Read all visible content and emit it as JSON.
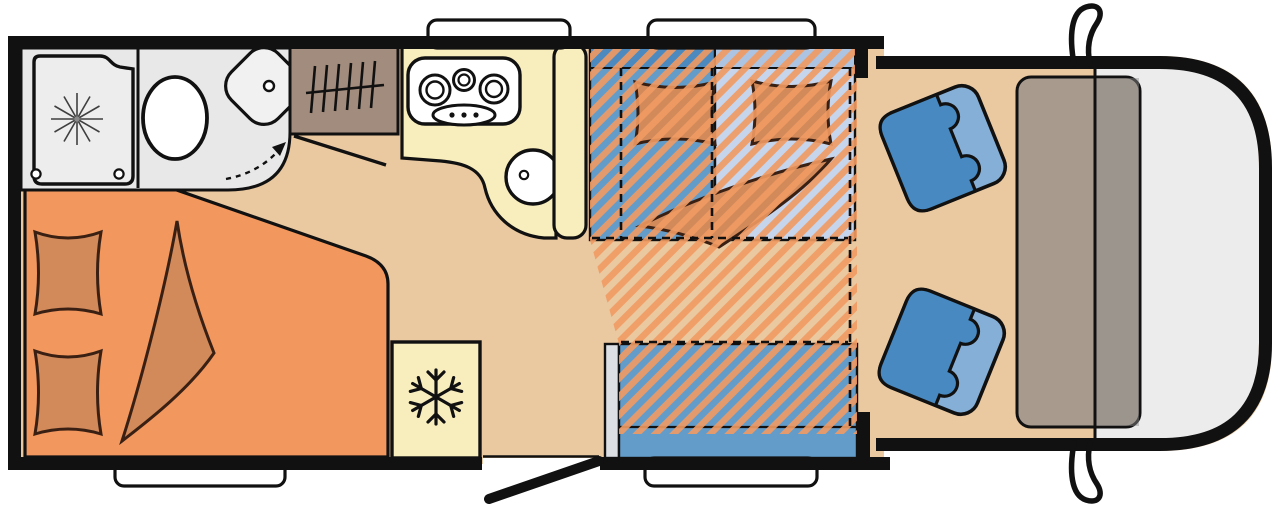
{
  "meta": {
    "type": "motorhome-floorplan",
    "description": "Top-down floor plan of a semi-integrated motorhome with rear bed, bathroom, kitchen, dinette with drop-down bed and driver cab"
  },
  "palette": {
    "outline": "#111111",
    "floor": "#EAC8A0",
    "bed": "#F2975E",
    "pillow": "#D28A5B",
    "pillow_stroke": "#3A2013",
    "bath_bg": "#E8E8E8",
    "tray": "#EDEDED",
    "white": "#FFFFFF",
    "wardrobe": "#A28C7D",
    "cream": "#F8EDBD",
    "bench": "#639CC9",
    "bench_dark": "#4B89BF",
    "mattress": "#C7D5EC",
    "mattress_dark": "#ACC4E1",
    "hatch": "#F19A62",
    "seat_dark": "#4789C0",
    "seat_light": "#85AFD7",
    "panel": "#DCE0E5",
    "dash_taupe": "#A89B8E",
    "dash_grey": "#8F8F8F",
    "nose": "#ECECEC",
    "star": "#3F3F3F"
  },
  "zones": {
    "bathroom": {
      "label": "Bathroom with shower, toilet and corner washbasin"
    },
    "shower": {
      "label": "Shower tray"
    },
    "toilet": {
      "label": "Toilet"
    },
    "washbasin": {
      "label": "Corner washbasin"
    },
    "wardrobe": {
      "label": "Wardrobe with clothes rail"
    },
    "rear_bed": {
      "label": "Rear bed with two pillows and blanket"
    },
    "kitchen": {
      "label": "Kitchen with 3-burner hob and sink"
    },
    "fridge": {
      "label": "Fridge"
    },
    "dinette": {
      "label": "Dinette bench seating"
    },
    "drop_down_bed": {
      "label": "Drop-down bed over dinette (hatched area)"
    },
    "side_bench": {
      "label": "Side bench"
    },
    "cab": {
      "label": "Driver cab with two swivel seats and dashboard"
    },
    "seat_top": {
      "label": "Swivel cab seat"
    },
    "seat_bottom": {
      "label": "Swivel cab seat"
    },
    "dashboard": {
      "label": "Dashboard"
    },
    "entry_door": {
      "label": "Entry door, open"
    },
    "windows": {
      "label": "Window",
      "count": 4
    },
    "mirrors": {
      "label": "Exterior mirror",
      "count": 2
    }
  },
  "icons": {
    "shower": "spray-star-icon",
    "fridge": "snowflake-icon",
    "wardrobe": "clothes-rail-icon",
    "hob": "three-burner-hob-icon",
    "sink": "round-sink-icon",
    "door_swing": "dashed-swing-arrow-icon"
  }
}
